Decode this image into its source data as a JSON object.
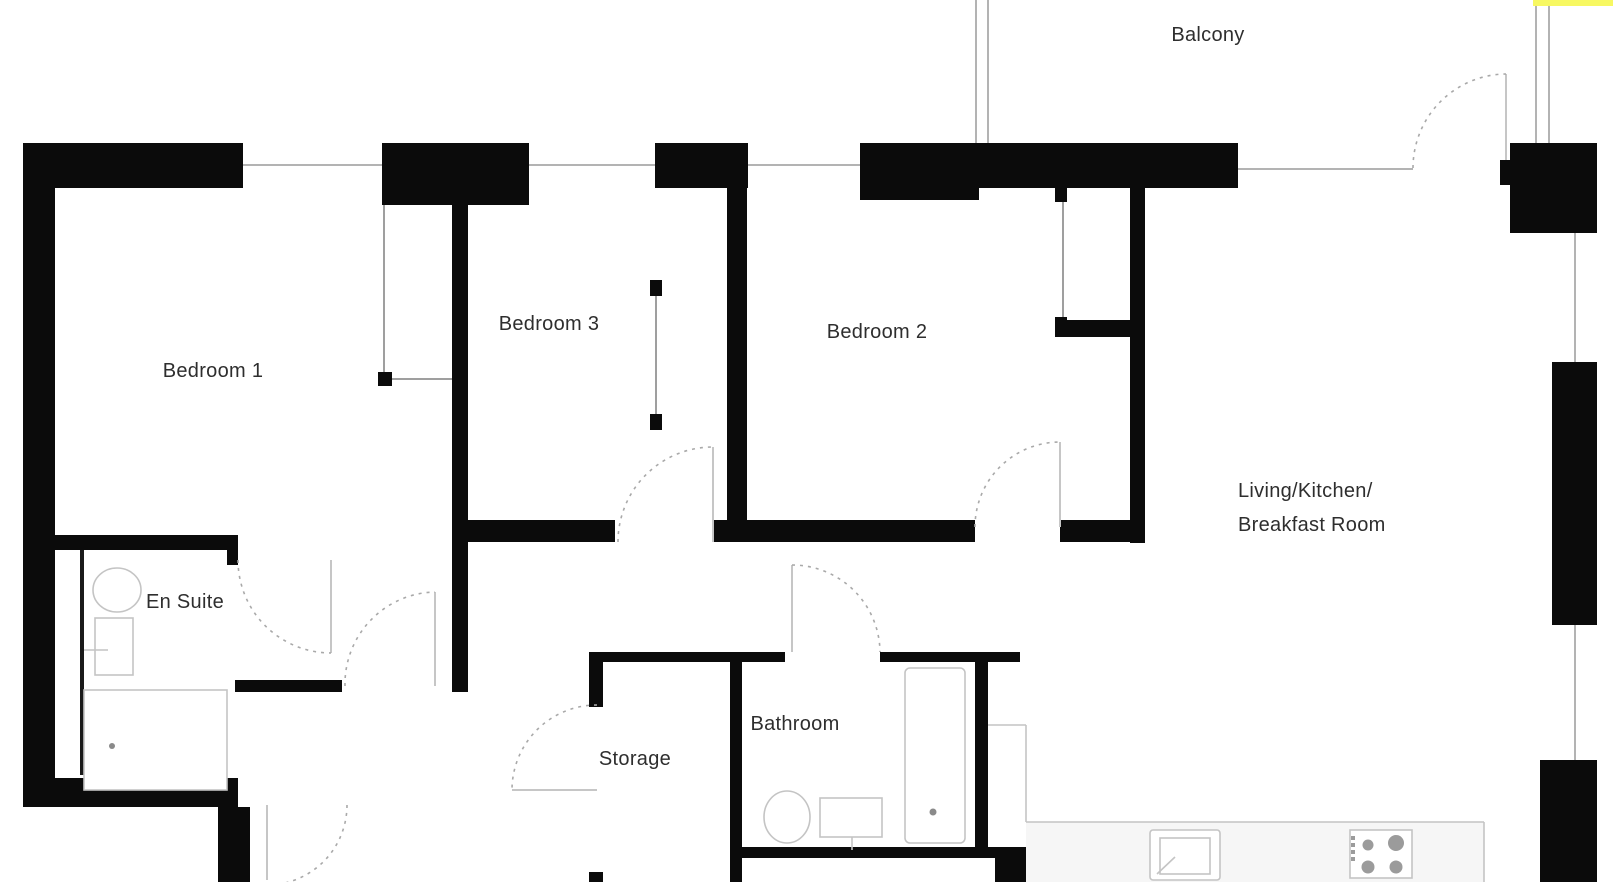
{
  "labels": {
    "bedroom1": "Bedroom 1",
    "bedroom2": "Bedroom 2",
    "bedroom3": "Bedroom 3",
    "balcony": "Balcony",
    "en_suite": "En Suite",
    "storage": "Storage",
    "bathroom": "Bathroom",
    "living_line1": "Living/Kitchen/",
    "living_line2": "Breakfast Room"
  },
  "colors": {
    "wall": "#0b0b0b",
    "window_line": "#b3b3b3",
    "door_dash": "#a9a9a9",
    "fixture_line": "#c4c4c4",
    "text": "#2e2e2e",
    "highlight_yellow": "#f7f862",
    "counter_fill": "#f6f6f6"
  }
}
